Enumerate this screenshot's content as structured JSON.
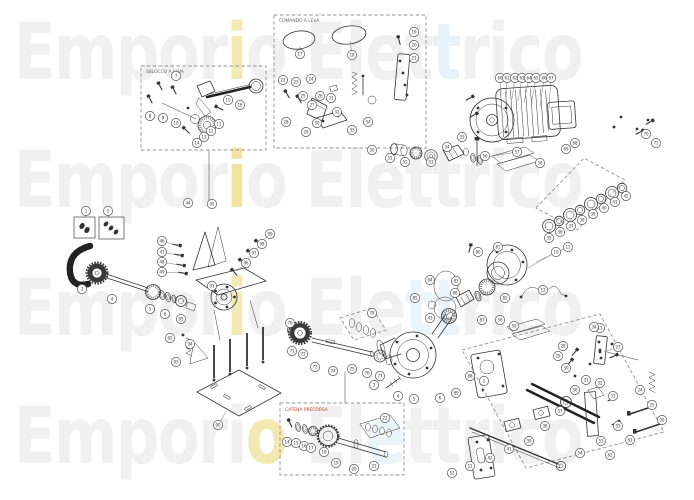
{
  "watermark": {
    "text": "Emporio Elettrico",
    "color": "#f0f0f0",
    "rows": [
      {
        "segments": [
          {
            "t": "Empor"
          },
          {
            "t": "i",
            "c": "#f5e9b4"
          },
          {
            "t": "o Elet"
          },
          {
            "t": "t",
            "c": "#e6f2fa"
          },
          {
            "t": "rico"
          }
        ]
      },
      {
        "segments": [
          {
            "t": "Empor"
          },
          {
            "t": "i",
            "c": "#f2e3a0"
          },
          {
            "t": "o Elettrico"
          }
        ]
      },
      {
        "segments": [
          {
            "t": "Empor"
          },
          {
            "t": "i",
            "c": "#f5e9b4"
          },
          {
            "t": "o Ele"
          },
          {
            "t": "tt",
            "c": "#e9f4fb"
          },
          {
            "t": "rico"
          }
        ]
      },
      {
        "segments": [
          {
            "t": "Empori"
          },
          {
            "t": "o",
            "c": "#f4e8b2"
          },
          {
            "t": " El"
          },
          {
            "t": "e",
            "c": "#e9f4fb"
          },
          {
            "t": "ttrico"
          }
        ]
      }
    ]
  },
  "insets": {
    "lever_release": {
      "label": "SBLOCCO A LEVA"
    },
    "lever_control": {
      "label": "COMANDO A LEVA"
    },
    "chain_kit": {
      "label": "CATENA PRECORSA",
      "label_color": "#b04a2a"
    }
  },
  "diagram": {
    "balloons": [
      {
        "n": "7",
        "x": 176,
        "y": 76
      },
      {
        "n": "8",
        "x": 150,
        "y": 116
      },
      {
        "n": "9",
        "x": 163,
        "y": 118
      },
      {
        "n": "10",
        "x": 176,
        "y": 123
      },
      {
        "n": "11",
        "x": 219,
        "y": 124
      },
      {
        "n": "12",
        "x": 211,
        "y": 131
      },
      {
        "n": "13",
        "x": 204,
        "y": 137
      },
      {
        "n": "14",
        "x": 197,
        "y": 143
      },
      {
        "n": "15",
        "x": 228,
        "y": 100
      },
      {
        "n": "16",
        "x": 240,
        "y": 105
      },
      {
        "n": "17",
        "x": 300,
        "y": 54,
        "tx": 300,
        "ty": 46
      },
      {
        "n": "18",
        "x": 352,
        "y": 55,
        "tx": 350,
        "ty": 41
      },
      {
        "n": "19",
        "x": 414,
        "y": 32
      },
      {
        "n": "20",
        "x": 414,
        "y": 45
      },
      {
        "n": "21",
        "x": 414,
        "y": 58
      },
      {
        "n": "22",
        "x": 283,
        "y": 80
      },
      {
        "n": "23",
        "x": 296,
        "y": 82
      },
      {
        "n": "24",
        "x": 311,
        "y": 79
      },
      {
        "n": "25",
        "x": 303,
        "y": 96
      },
      {
        "n": "26",
        "x": 320,
        "y": 96
      },
      {
        "n": "27",
        "x": 312,
        "y": 105
      },
      {
        "n": "28",
        "x": 286,
        "y": 122
      },
      {
        "n": "29",
        "x": 306,
        "y": 132
      },
      {
        "n": "30",
        "x": 317,
        "y": 123
      },
      {
        "n": "31",
        "x": 331,
        "y": 98
      },
      {
        "n": "32",
        "x": 337,
        "y": 112
      },
      {
        "n": "33",
        "x": 352,
        "y": 130
      },
      {
        "n": "34",
        "x": 368,
        "y": 122
      },
      {
        "n": "60",
        "x": 500,
        "y": 78,
        "tx": 501,
        "ty": 95
      },
      {
        "n": "61",
        "x": 507,
        "y": 78,
        "tx": 506,
        "ty": 97
      },
      {
        "n": "62",
        "x": 515,
        "y": 78,
        "tx": 512,
        "ty": 99
      },
      {
        "n": "63",
        "x": 522,
        "y": 78,
        "tx": 518,
        "ty": 101
      },
      {
        "n": "64",
        "x": 529,
        "y": 78,
        "tx": 524,
        "ty": 103
      },
      {
        "n": "65",
        "x": 536,
        "y": 78,
        "tx": 531,
        "ty": 105
      },
      {
        "n": "66",
        "x": 544,
        "y": 78,
        "tx": 540,
        "ty": 107
      },
      {
        "n": "67",
        "x": 551,
        "y": 78,
        "tx": 549,
        "ty": 108
      },
      {
        "n": "68",
        "x": 575,
        "y": 143
      },
      {
        "n": "69",
        "x": 566,
        "y": 149
      },
      {
        "n": "70",
        "x": 646,
        "y": 134
      },
      {
        "n": "71",
        "x": 656,
        "y": 143
      },
      {
        "n": "50",
        "x": 372,
        "y": 150
      },
      {
        "n": "51",
        "x": 390,
        "y": 158
      },
      {
        "n": "52",
        "x": 405,
        "y": 162
      },
      {
        "n": "53",
        "x": 431,
        "y": 162
      },
      {
        "n": "54",
        "x": 447,
        "y": 147
      },
      {
        "n": "55",
        "x": 462,
        "y": 137
      },
      {
        "n": "56",
        "x": 485,
        "y": 156
      },
      {
        "n": "57",
        "x": 517,
        "y": 152,
        "tx": 480,
        "ty": 158
      },
      {
        "n": "58",
        "x": 540,
        "y": 163
      },
      {
        "n": "35",
        "x": 549,
        "y": 238,
        "tx": 550,
        "ty": 230
      },
      {
        "n": "36",
        "x": 560,
        "y": 232,
        "tx": 560,
        "ty": 224
      },
      {
        "n": "37",
        "x": 571,
        "y": 226,
        "tx": 571,
        "ty": 218
      },
      {
        "n": "38",
        "x": 582,
        "y": 220,
        "tx": 581,
        "ty": 213
      },
      {
        "n": "39",
        "x": 593,
        "y": 214,
        "tx": 592,
        "ty": 207
      },
      {
        "n": "40",
        "x": 604,
        "y": 208,
        "tx": 602,
        "ty": 201
      },
      {
        "n": "41",
        "x": 615,
        "y": 202,
        "tx": 613,
        "ty": 196
      },
      {
        "n": "42",
        "x": 626,
        "y": 196,
        "tx": 623,
        "ty": 190
      },
      {
        "n": "80",
        "x": 478,
        "y": 252
      },
      {
        "n": "81",
        "x": 498,
        "y": 247
      },
      {
        "n": "82",
        "x": 505,
        "y": 298
      },
      {
        "n": "83",
        "x": 456,
        "y": 281
      },
      {
        "n": "84",
        "x": 430,
        "y": 280
      },
      {
        "n": "85",
        "x": 415,
        "y": 298
      },
      {
        "n": "86",
        "x": 455,
        "y": 293
      },
      {
        "n": "87",
        "x": 482,
        "y": 320
      },
      {
        "n": "43",
        "x": 430,
        "y": 318
      },
      {
        "n": "1",
        "x": 86,
        "y": 211,
        "tx": 85,
        "ty": 218
      },
      {
        "n": "2",
        "x": 108,
        "y": 211,
        "tx": 109,
        "ty": 218
      },
      {
        "n": "3",
        "x": 82,
        "y": 289
      },
      {
        "n": "4",
        "x": 112,
        "y": 299
      },
      {
        "n": "5",
        "x": 150,
        "y": 309
      },
      {
        "n": "6",
        "x": 165,
        "y": 314
      },
      {
        "n": "95",
        "x": 181,
        "y": 319
      },
      {
        "n": "44",
        "x": 188,
        "y": 203
      },
      {
        "n": "45",
        "x": 212,
        "y": 204
      },
      {
        "n": "46",
        "x": 162,
        "y": 241,
        "tx": 175,
        "ty": 245
      },
      {
        "n": "47",
        "x": 162,
        "y": 252,
        "tx": 177,
        "ty": 255
      },
      {
        "n": "48",
        "x": 162,
        "y": 262,
        "tx": 179,
        "ty": 265
      },
      {
        "n": "49",
        "x": 162,
        "y": 272,
        "tx": 181,
        "ty": 273
      },
      {
        "n": "90",
        "x": 218,
        "y": 425,
        "tx": 226,
        "ty": 412
      },
      {
        "n": "91",
        "x": 212,
        "y": 286
      },
      {
        "n": "92",
        "x": 170,
        "y": 338
      },
      {
        "n": "93",
        "x": 176,
        "y": 362
      },
      {
        "n": "94",
        "x": 190,
        "y": 344
      },
      {
        "n": "96",
        "x": 246,
        "y": 263,
        "tx": 237,
        "ty": 271
      },
      {
        "n": "97",
        "x": 254,
        "y": 253,
        "tx": 245,
        "ty": 261
      },
      {
        "n": "98",
        "x": 262,
        "y": 244,
        "tx": 253,
        "ty": 252
      },
      {
        "n": "99",
        "x": 270,
        "y": 234,
        "tx": 261,
        "ty": 242
      },
      {
        "n": "71",
        "x": 292,
        "y": 351
      },
      {
        "n": "72",
        "x": 303,
        "y": 354
      },
      {
        "n": "73",
        "x": 315,
        "y": 367
      },
      {
        "n": "74",
        "x": 333,
        "y": 371
      },
      {
        "n": "75",
        "x": 352,
        "y": 369
      },
      {
        "n": "76",
        "x": 367,
        "y": 373
      },
      {
        "n": "77",
        "x": 380,
        "y": 376
      },
      {
        "n": "78",
        "x": 372,
        "y": 313
      },
      {
        "n": "79",
        "x": 290,
        "y": 323
      },
      {
        "n": "3",
        "x": 374,
        "y": 385
      },
      {
        "n": "4",
        "x": 398,
        "y": 396
      },
      {
        "n": "5",
        "x": 414,
        "y": 399
      },
      {
        "n": "6",
        "x": 440,
        "y": 398
      },
      {
        "n": "89",
        "x": 456,
        "y": 393
      },
      {
        "n": "88",
        "x": 470,
        "y": 376
      },
      {
        "n": "2",
        "x": 484,
        "y": 381
      },
      {
        "n": "10",
        "x": 556,
        "y": 252,
        "tx": 528,
        "ty": 268
      },
      {
        "n": "11",
        "x": 568,
        "y": 247,
        "tx": 536,
        "ty": 262
      },
      {
        "n": "12",
        "x": 543,
        "y": 290
      },
      {
        "n": "13",
        "x": 600,
        "y": 328
      },
      {
        "n": "27",
        "x": 618,
        "y": 347,
        "tx": 604,
        "ty": 352
      },
      {
        "n": "28",
        "x": 563,
        "y": 346
      },
      {
        "n": "29",
        "x": 558,
        "y": 356
      },
      {
        "n": "30",
        "x": 566,
        "y": 368
      },
      {
        "n": "31",
        "x": 586,
        "y": 380
      },
      {
        "n": "32",
        "x": 600,
        "y": 383
      },
      {
        "n": "33",
        "x": 613,
        "y": 396
      },
      {
        "n": "34",
        "x": 594,
        "y": 327
      },
      {
        "n": "36",
        "x": 575,
        "y": 390
      },
      {
        "n": "37",
        "x": 560,
        "y": 411
      },
      {
        "n": "38",
        "x": 545,
        "y": 426
      },
      {
        "n": "39",
        "x": 529,
        "y": 441
      },
      {
        "n": "41",
        "x": 509,
        "y": 449
      },
      {
        "n": "42",
        "x": 490,
        "y": 458
      },
      {
        "n": "51",
        "x": 470,
        "y": 466
      },
      {
        "n": "52",
        "x": 452,
        "y": 473
      },
      {
        "n": "53",
        "x": 601,
        "y": 441
      },
      {
        "n": "54",
        "x": 580,
        "y": 453
      },
      {
        "n": "55",
        "x": 618,
        "y": 426
      },
      {
        "n": "56",
        "x": 500,
        "y": 320
      },
      {
        "n": "59",
        "x": 514,
        "y": 326
      },
      {
        "n": "24",
        "x": 640,
        "y": 390
      },
      {
        "n": "25",
        "x": 652,
        "y": 405
      },
      {
        "n": "26",
        "x": 662,
        "y": 420
      },
      {
        "n": "61",
        "x": 630,
        "y": 440
      },
      {
        "n": "62",
        "x": 610,
        "y": 455
      },
      {
        "n": "14",
        "x": 287,
        "y": 442
      },
      {
        "n": "15",
        "x": 296,
        "y": 443
      },
      {
        "n": "16",
        "x": 304,
        "y": 446
      },
      {
        "n": "17",
        "x": 311,
        "y": 448
      },
      {
        "n": "18",
        "x": 324,
        "y": 452
      },
      {
        "n": "19",
        "x": 336,
        "y": 463
      },
      {
        "n": "20",
        "x": 354,
        "y": 469
      },
      {
        "n": "21",
        "x": 374,
        "y": 466
      },
      {
        "n": "22",
        "x": 385,
        "y": 418
      }
    ]
  }
}
